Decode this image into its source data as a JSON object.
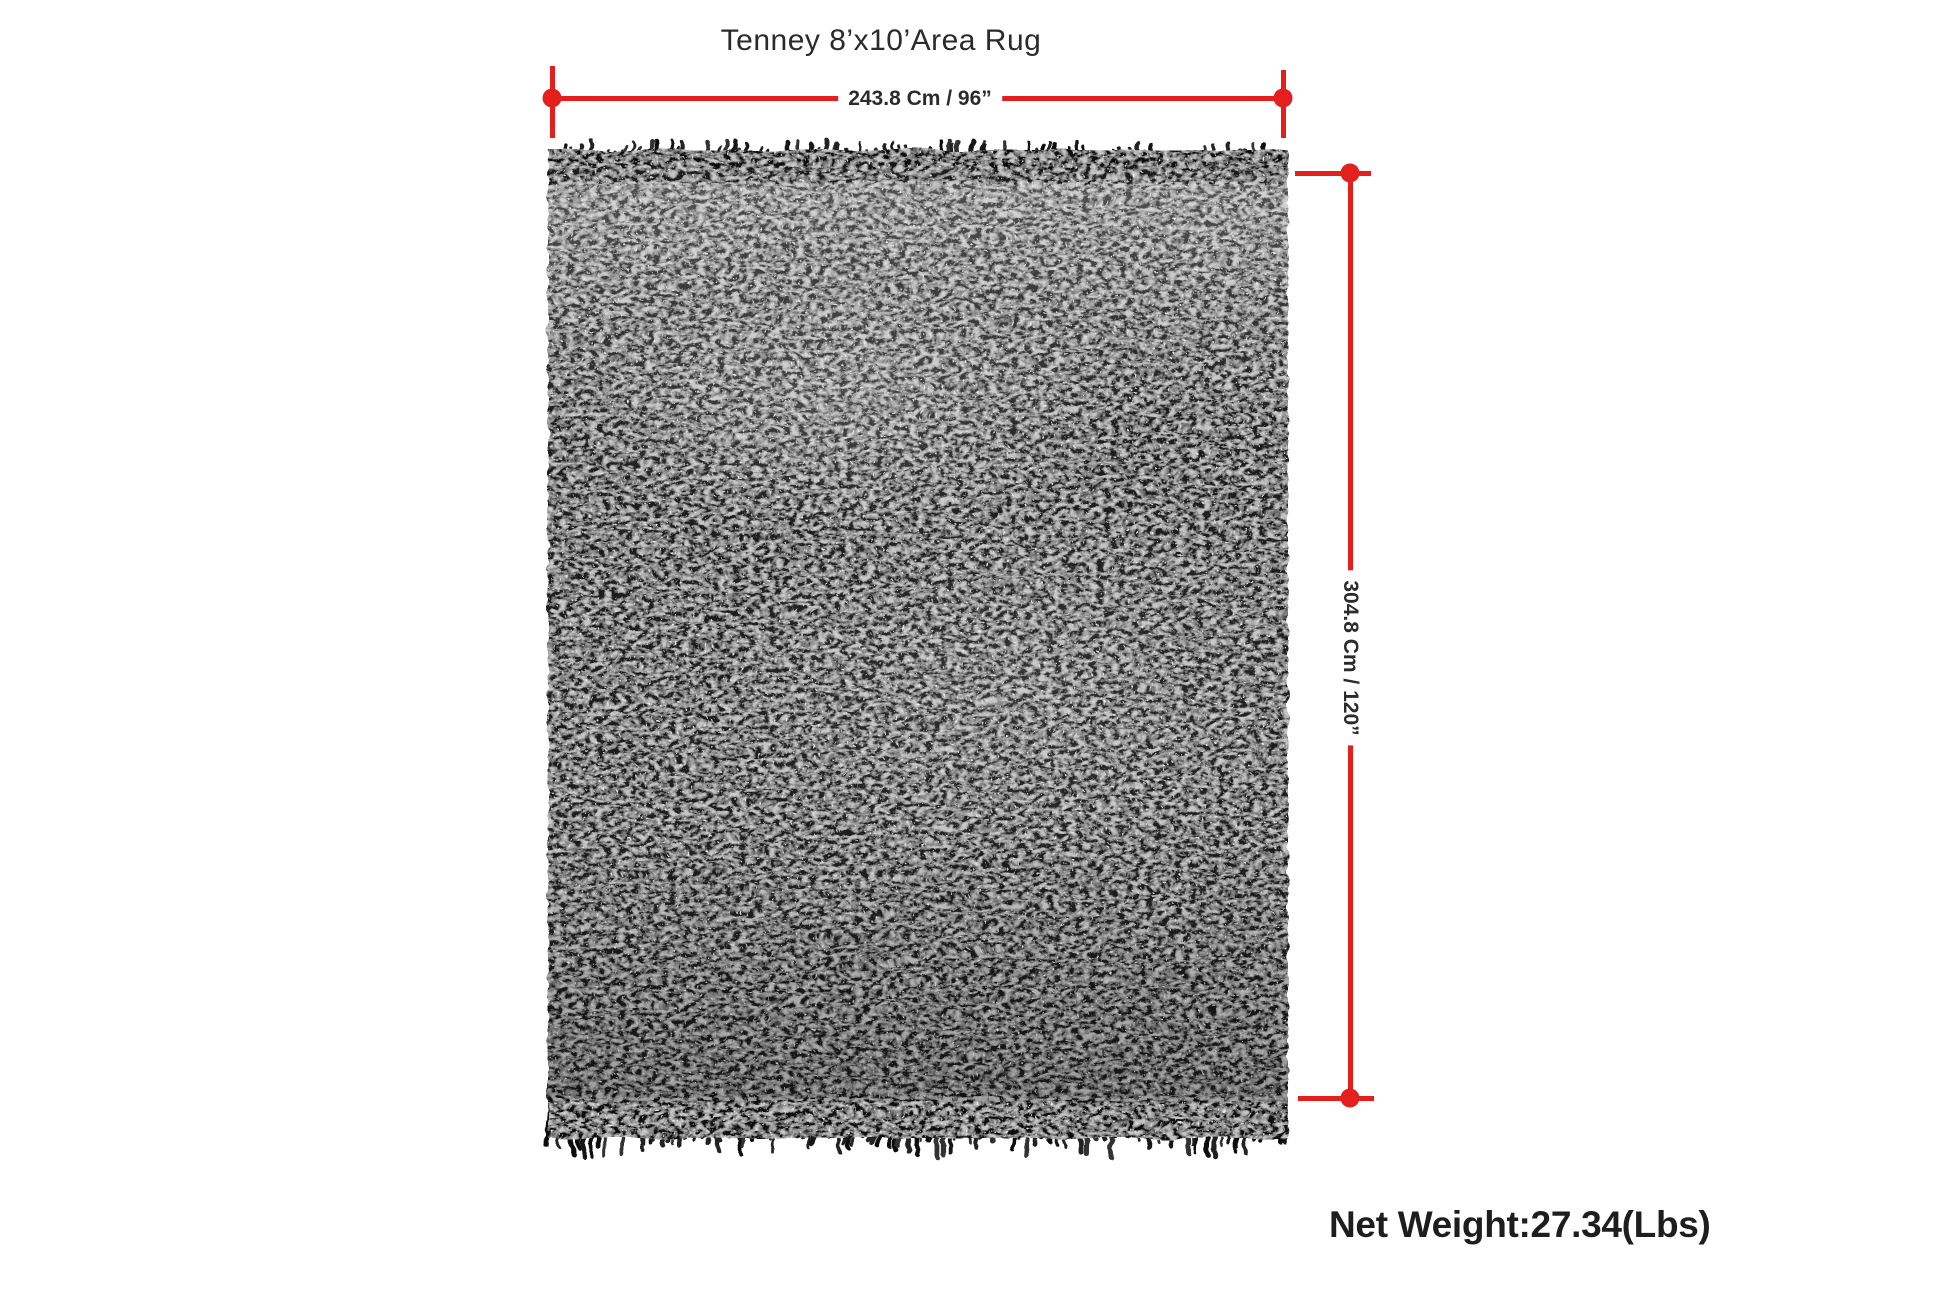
{
  "diagram": {
    "title": "Tenney 8’x10’Area Rug",
    "dimensions": {
      "width_label": "243.8 Cm / 96”",
      "height_label": "304.8 Cm / 120”"
    },
    "net_weight": "Net Weight:27.34(Lbs)",
    "accent_color": "#e3201e",
    "rug": {
      "color": "#1b1b1b",
      "fringe_color": "#0f0f0f"
    }
  }
}
